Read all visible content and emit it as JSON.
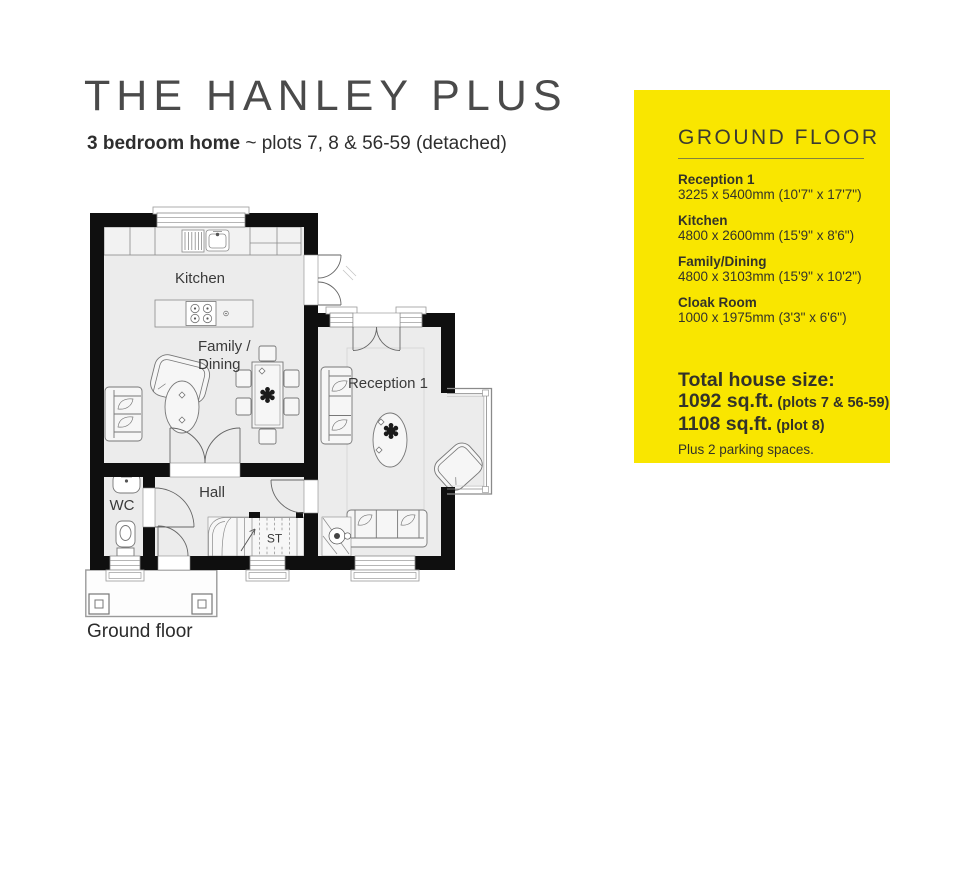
{
  "header": {
    "title": "THE HANLEY PLUS",
    "subtitle_bold": "3 bedroom home",
    "subtitle_rest": " ~ plots 7, 8 & 56-59 (detached)"
  },
  "plan": {
    "caption": "Ground floor",
    "room_labels": {
      "kitchen": "Kitchen",
      "family_line1": "Family /",
      "family_line2": "Dining",
      "reception": "Reception 1",
      "hall": "Hall",
      "wc": "WC",
      "st": "ST"
    }
  },
  "panel": {
    "background": "#F9E600",
    "heading": "GROUND FLOOR",
    "rooms": [
      {
        "name": "Reception 1",
        "dims": "3225 x 5400mm (10'7\" x 17'7\")"
      },
      {
        "name": "Kitchen",
        "dims": "4800 x 2600mm (15'9\" x 8'6\")"
      },
      {
        "name": "Family/Dining",
        "dims": "4800 x 3103mm (15'9\" x 10'2\")"
      },
      {
        "name": "Cloak Room",
        "dims": "1000 x 1975mm (3'3\" x 6'6\")"
      }
    ],
    "total": {
      "label": "Total house size:",
      "line1_size": "1092 sq.ft.",
      "line1_note": "(plots 7 & 56-59)",
      "line2_size": "1108 sq.ft.",
      "line2_note": "(plot 8)",
      "parking": "Plus 2 parking spaces."
    }
  }
}
